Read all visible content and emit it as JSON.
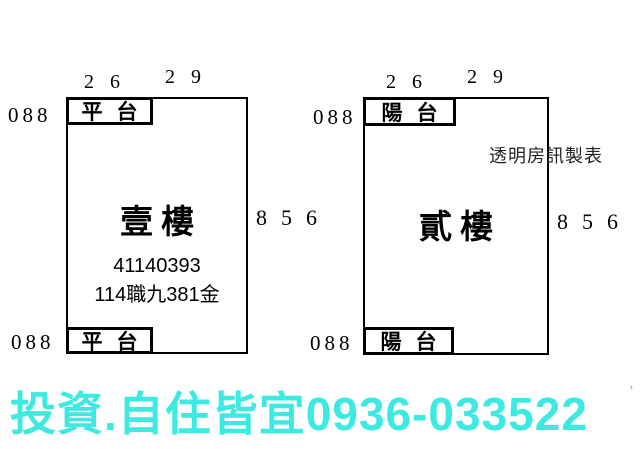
{
  "page": {
    "background": "#ffffff",
    "line_color": "#000000"
  },
  "units": [
    {
      "name": "壹樓",
      "terrace_top_label": "平台",
      "terrace_bottom_label": "平台",
      "dim_top_left": "26",
      "dim_top_right": "29",
      "dim_left_top": "088",
      "dim_left_bottom": "088",
      "dim_right": "856",
      "code_line1": "41140393",
      "code_line2": "114職九381金"
    },
    {
      "name": "貳樓",
      "terrace_top_label": "陽台",
      "terrace_bottom_label": "陽台",
      "dim_top_left": "26",
      "dim_top_right": "29",
      "dim_left_top": "088",
      "dim_left_bottom": "088",
      "dim_right": "856",
      "watermark": "透明房訊製表"
    }
  ],
  "footer": {
    "text": "投資.自住皆宜0936-033522",
    "color": "#3DEAE2"
  },
  "stray_mark": "’"
}
